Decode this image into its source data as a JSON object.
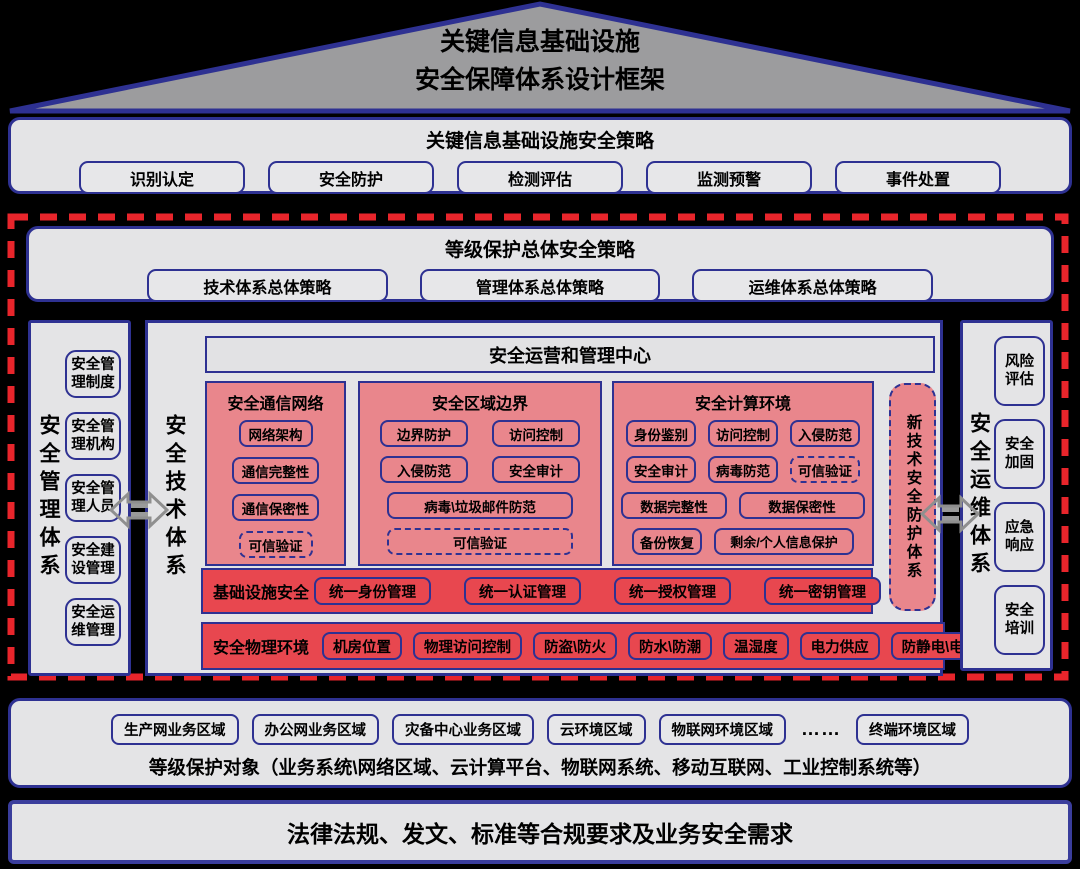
{
  "colors": {
    "navy_border": "#2e3192",
    "pink_panel": "#e9868c",
    "red_row": "#e8474f",
    "gray_box": "#e4e4e6",
    "roof_gray": "#9c9c9e",
    "dash_red": "#e8252b",
    "arrow_gray": "#8f8f8f",
    "background": "#000000"
  },
  "roof": {
    "title_line1": "关键信息基础设施",
    "title_line2": "安全保障体系设计框架"
  },
  "policy": {
    "title": "关键信息基础设施安全策略",
    "items": [
      "识别认定",
      "安全防护",
      "检测评估",
      "监测预警",
      "事件处置"
    ]
  },
  "strategy": {
    "title": "等级保护总体安全策略",
    "items": [
      "技术体系总体策略",
      "管理体系总体策略",
      "运维体系总体策略"
    ]
  },
  "management": {
    "label": "安全管理体系",
    "items": [
      "安全管理制度",
      "安全管理机构",
      "安全管理人员",
      "安全建设管理",
      "安全运维管理"
    ]
  },
  "technology": {
    "label": "安全技术体系",
    "ops_center": "安全运营和管理中心",
    "panels": [
      {
        "title": "安全通信网络",
        "items": [
          "网络架构",
          "通信完整性",
          "通信保密性",
          "可信验证"
        ]
      },
      {
        "title": "安全区域边界",
        "items": [
          "边界防护",
          "访问控制",
          "入侵防范",
          "安全审计",
          "病毒\\垃圾邮件防范",
          "可信验证"
        ]
      },
      {
        "title": "安全计算环境",
        "items": [
          "身份鉴别",
          "访问控制",
          "入侵防范",
          "安全审计",
          "病毒防范",
          "可信验证",
          "数据完整性",
          "数据保密性",
          "备份恢复",
          "剩余/个人信息保护"
        ]
      }
    ],
    "new_tech": "新技术安全防护体系",
    "infra": {
      "label": "基础设施安全",
      "items": [
        "统一身份管理",
        "统一认证管理",
        "统一授权管理",
        "统一密钥管理"
      ]
    },
    "physical": {
      "label": "安全物理环境",
      "items": [
        "机房位置",
        "物理访问控制",
        "防盗\\防火",
        "防水\\防潮",
        "温湿度",
        "电力供应",
        "防静电\\电磁"
      ]
    }
  },
  "operations": {
    "label": "安全运维体系",
    "items": [
      "风险评估",
      "安全加固",
      "应急响应",
      "安全培训"
    ]
  },
  "targets": {
    "zones": [
      "生产网业务区域",
      "办公网业务区域",
      "灾备中心业务区域",
      "云环境区域",
      "物联网环境区域",
      "……",
      "终端环境区域"
    ],
    "caption": "等级保护对象（业务系统\\网络区域、云计算平台、物联网系统、移动互联网、工业控制系统等）"
  },
  "law": {
    "text": "法律法规、发文、标准等合规要求及业务安全需求"
  }
}
